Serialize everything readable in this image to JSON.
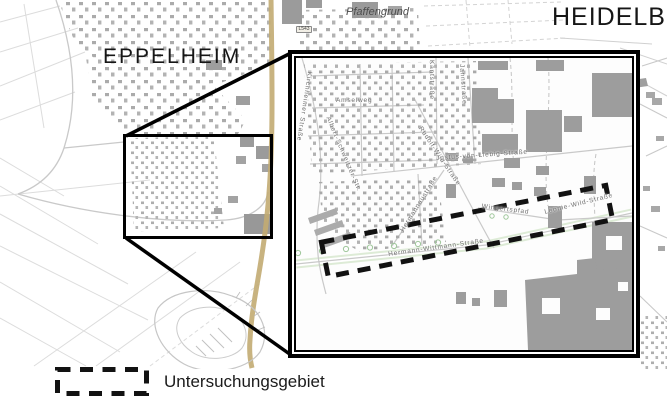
{
  "labels": {
    "city_left": "EPPELHEIM",
    "city_right": "HEIDELBERG",
    "district": "Pfaffengrund",
    "road_shield": "L543"
  },
  "inset": {
    "street_names": [
      "Kirchheimer Straße",
      "Amselweg",
      "Albert-Schweitzer-Str.",
      "Kantstraße",
      "Jahnstraße",
      "Rudolf-Wild-Straße",
      "Justus-von-Liebig-Straße",
      "Hermannaustraße",
      "Wingertspfad",
      "Leonie-Wild-Straße",
      "Hermann-Wittmann-Straße"
    ]
  },
  "legend": {
    "study_area_label": "Untersuchungsgebiet"
  },
  "colors": {
    "building_gray": "#a0a0a0",
    "main_road_tan": "#c2ab72",
    "tree_green": "#9fc79b",
    "study_area_outline": "#121212",
    "map_line_gray": "#c9c9c9"
  }
}
